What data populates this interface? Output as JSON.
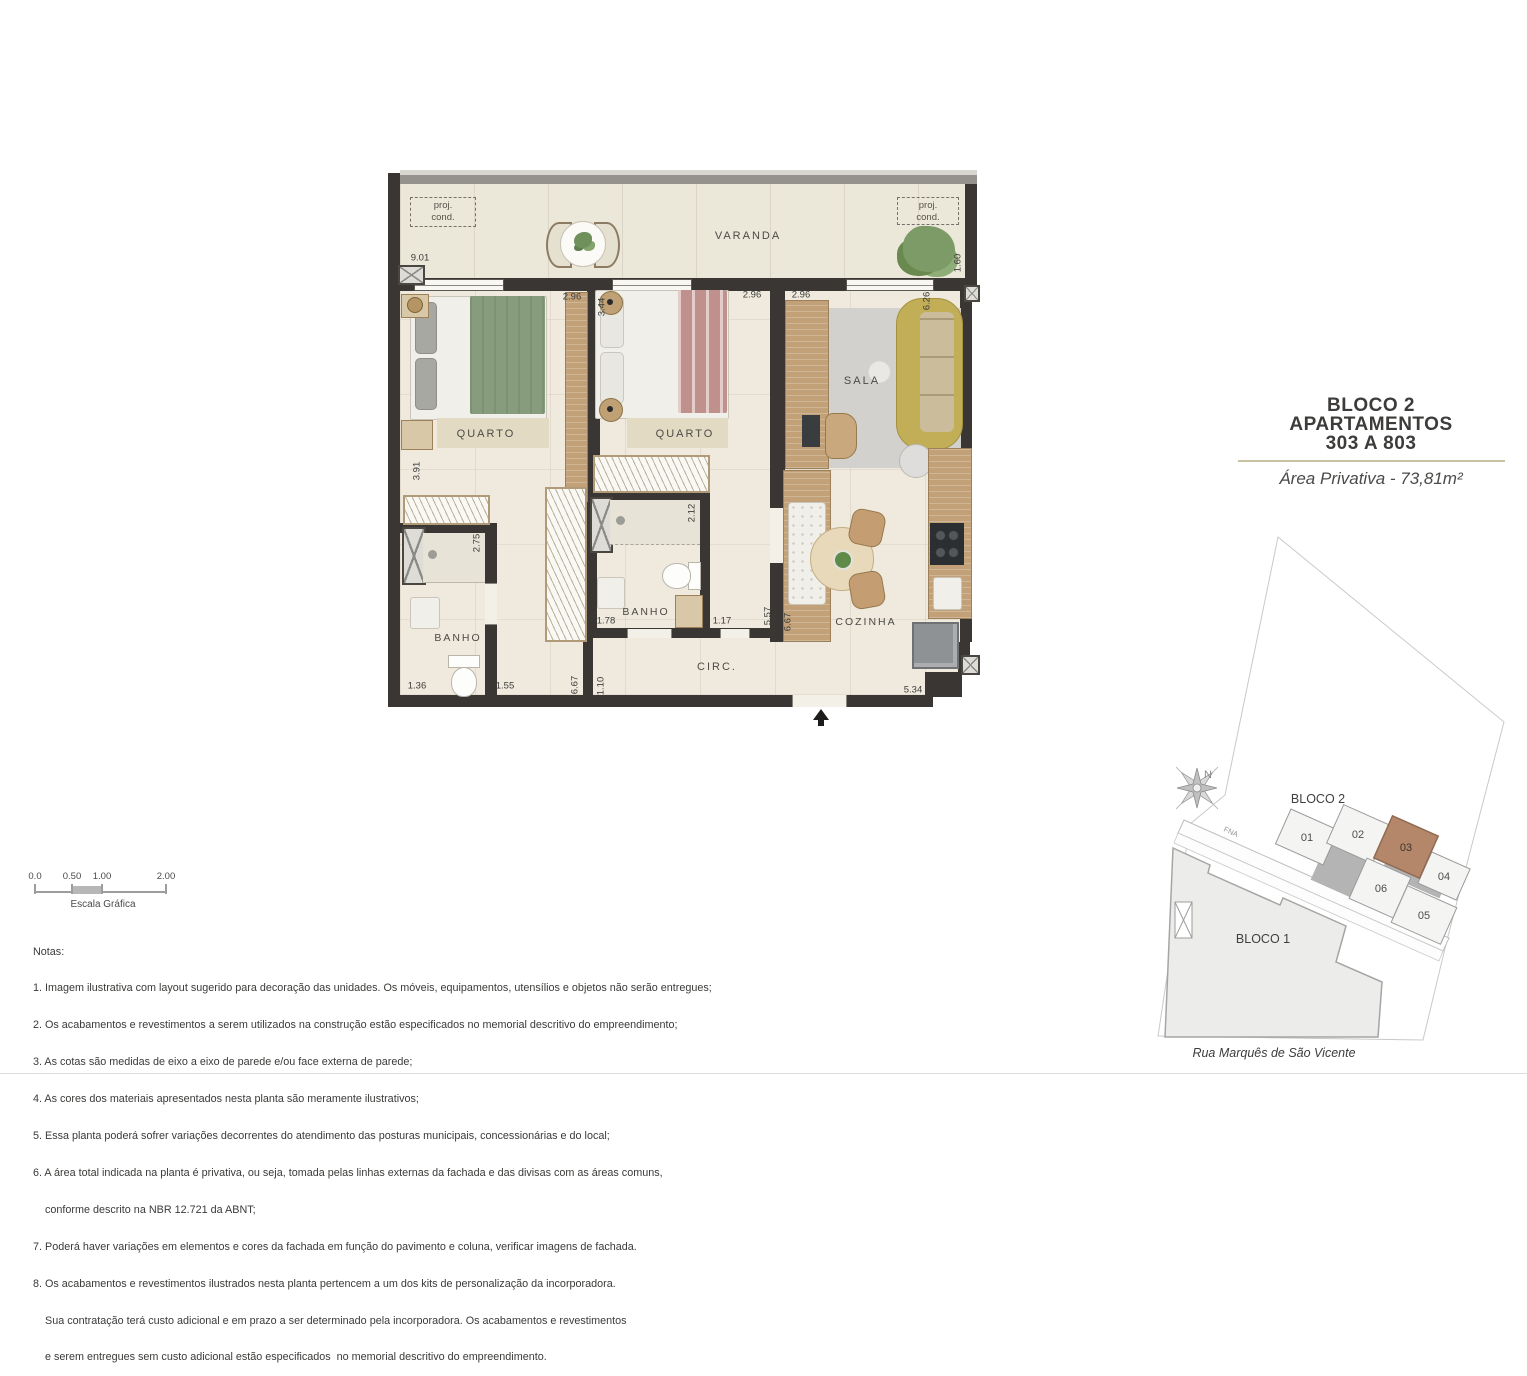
{
  "title_block": {
    "line1": "BLOCO 2",
    "line2": "APARTAMENTOS",
    "line3": "303 A 803",
    "area": "Área Privativa - 73,81m²"
  },
  "plan": {
    "rooms": {
      "varanda": "VARANDA",
      "quarto": "QUARTO",
      "sala": "SALA",
      "banho": "BANHO",
      "circ": "CIRC.",
      "cozinha": "COZINHA"
    },
    "proj_cond": {
      "line1": "proj.",
      "line2": "cond."
    },
    "dims": {
      "d901": "9.01",
      "d160": "1.60",
      "d296": "2.96",
      "d344": "3.44",
      "d626": "6.26",
      "d391": "3.91",
      "d275": "2.75",
      "d136": "1.36",
      "d155": "1.55",
      "d212": "2.12",
      "d178": "1.78",
      "d117": "1.17",
      "d557": "5.57",
      "d667": "6.67",
      "d110": "1.10",
      "d534": "5.34"
    }
  },
  "scale_bar": {
    "ticks": [
      "0.0",
      "0.50",
      "1.00",
      "2.00"
    ],
    "caption": "Escala Gráfica"
  },
  "notes": {
    "heading": "Notas:",
    "lines": [
      "1. Imagem ilustrativa com layout sugerido para decoração das unidades. Os móveis, equipamentos, utensílios e objetos não serão entregues;",
      "2. Os acabamentos e revestimentos a serem utilizados na construção estão especificados no memorial descritivo do empreendimento;",
      "3. As cotas são medidas de eixo a eixo de parede e/ou face externa de parede;",
      "4. As cores dos materiais apresentados nesta planta são meramente ilustrativos;",
      "5. Essa planta poderá sofrer variações decorrentes do atendimento das posturas municipais, concessionárias e do local;",
      "6. A área total indicada na planta é privativa, ou seja, tomada pelas linhas externas da fachada e das divisas com as áreas comuns,",
      "    conforme descrito na NBR 12.721 da ABNT;",
      "7. Poderá haver variações em elementos e cores da fachada em função do pavimento e coluna, verificar imagens de fachada.",
      "8. Os acabamentos e revestimentos ilustrados nesta planta pertencem a um dos kits de personalização da incorporadora.",
      "    Sua contratação terá custo adicional e em prazo a ser determinado pela incorporadora. Os acabamentos e revestimentos",
      "    e serem entregues sem custo adicional estão especificados  no memorial descritivo do empreendimento."
    ]
  },
  "site_map": {
    "bloco1": "BLOCO 1",
    "bloco2": "BLOCO 2",
    "units": {
      "u01": "01",
      "u02": "02",
      "u03": "03",
      "u04": "04",
      "u05": "05",
      "u06": "06"
    },
    "north": "N",
    "road_tag": "FNA",
    "street": "Rua Marquês de São Vicente"
  }
}
